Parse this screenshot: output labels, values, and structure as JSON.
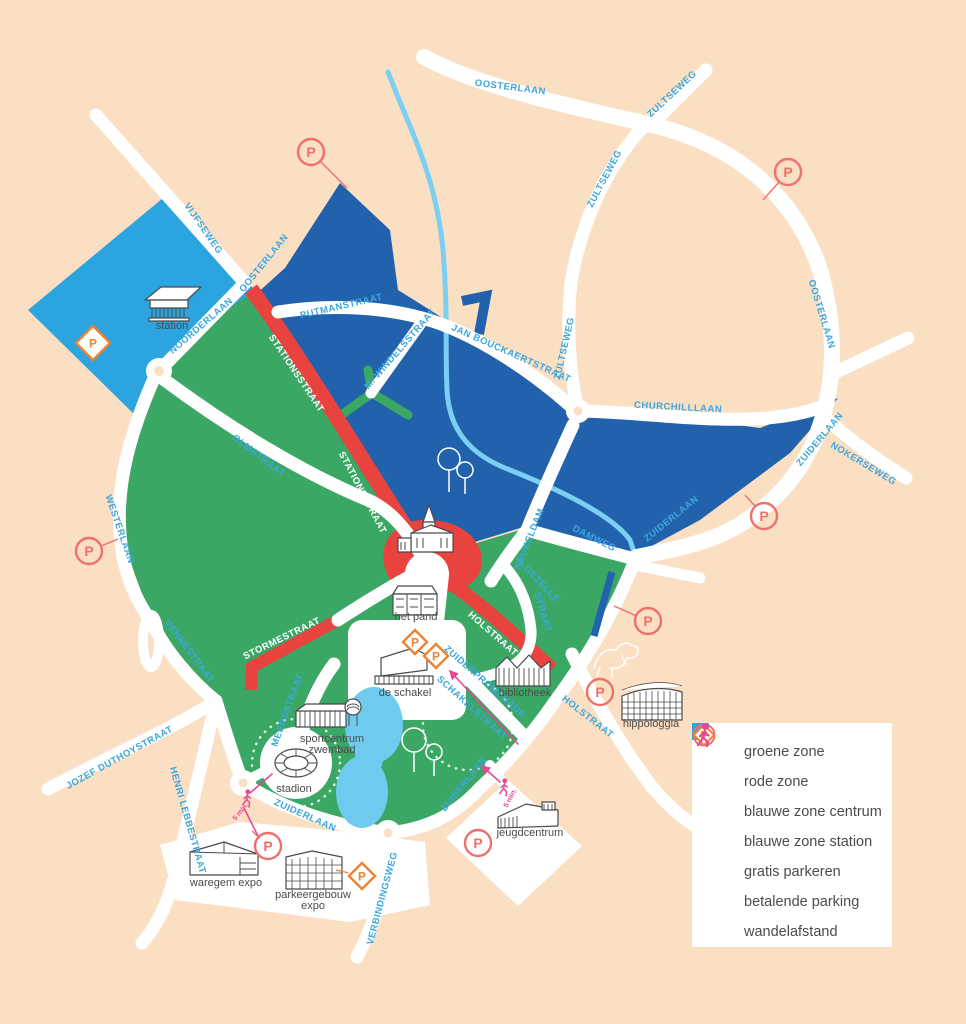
{
  "colors": {
    "background": "#FBDFC3",
    "road": "#FFFFFF",
    "green_zone": "#3BA765",
    "red_zone": "#E8433F",
    "blue_zone_centrum": "#2262AC",
    "blue_zone_station": "#2BA4DF",
    "canal": "#7ACFF2",
    "street_label": "#3BA7DF",
    "walk_pink": "#E84793",
    "p_circle": "#F06F6B",
    "p_diamond": "#EE8330",
    "label_text": "#4B4B4B"
  },
  "legend": {
    "items": [
      {
        "label": "groene zone",
        "type": "swatch",
        "color": "#3BA765"
      },
      {
        "label": "rode zone",
        "type": "swatch",
        "color": "#E8433F"
      },
      {
        "label": "blauwe zone centrum",
        "type": "swatch",
        "color": "#2262AC"
      },
      {
        "label": "blauwe zone station",
        "type": "swatch",
        "color": "#2BA4DF"
      },
      {
        "label": "gratis parkeren",
        "type": "p-circle"
      },
      {
        "label": "betalende parking",
        "type": "p-diamond"
      },
      {
        "label": "wandelafstand",
        "type": "walker"
      }
    ]
  },
  "map": {
    "street_labels": [
      {
        "name": "OOSTERLAAN",
        "x": 510,
        "y": 90,
        "rot": 7
      },
      {
        "name": "ZULTSEWEG",
        "x": 674,
        "y": 96,
        "rot": -43
      },
      {
        "name": "ZULTSEWEG",
        "x": 607,
        "y": 180,
        "rot": -62
      },
      {
        "name": "ZULTSEWEG",
        "x": 567,
        "y": 349,
        "rot": -77
      },
      {
        "name": "OOSTERLAAN",
        "x": 819,
        "y": 315,
        "rot": 73
      },
      {
        "name": "ZUIDERLAAN",
        "x": 822,
        "y": 441,
        "rot": -50
      },
      {
        "name": "NOKERSEWEG",
        "x": 862,
        "y": 466,
        "rot": 31
      },
      {
        "name": "CHURCHILLLAAN",
        "x": 678,
        "y": 410,
        "rot": 3
      },
      {
        "name": "VIJFSEWEG",
        "x": 201,
        "y": 230,
        "rot": 55
      },
      {
        "name": "OOSTERLAAN",
        "x": 266,
        "y": 265,
        "rot": -51
      },
      {
        "name": "NOORDERLAAN",
        "x": 203,
        "y": 328,
        "rot": -41
      },
      {
        "name": "PUTMANSTRAAT",
        "x": 342,
        "y": 309,
        "rot": -13
      },
      {
        "name": "JAN BOUCKAERTSTRAAT",
        "x": 510,
        "y": 356,
        "rot": 24
      },
      {
        "name": "M. WINDELSSTRAAT",
        "x": 402,
        "y": 351,
        "rot": -49
      },
      {
        "name": "STATIONSSTRAAT",
        "x": 294,
        "y": 375,
        "rot": 56,
        "on_red": true
      },
      {
        "name": "STATIONSSTRAAT",
        "x": 360,
        "y": 494,
        "rot": 62,
        "on_red": true
      },
      {
        "name": "WESTERLAAN",
        "x": 117,
        "y": 530,
        "rot": 71
      },
      {
        "name": "OLMSTRAAT",
        "x": 257,
        "y": 458,
        "rot": 37
      },
      {
        "name": "KEUKELDAM",
        "x": 532,
        "y": 540,
        "rot": -68
      },
      {
        "name": "DAMWEG",
        "x": 593,
        "y": 541,
        "rot": 27
      },
      {
        "name": "ZUIDERLAAN",
        "x": 673,
        "y": 521,
        "rot": -39
      },
      {
        "name": "G.GEZELLE",
        "x": 536,
        "y": 582,
        "rot": 46
      },
      {
        "name": "STRAAT",
        "x": 540,
        "y": 613,
        "rot": 73
      },
      {
        "name": "HOLSTRAAT",
        "x": 491,
        "y": 636,
        "rot": 41,
        "on_red": true
      },
      {
        "name": "HOLSTRAAT",
        "x": 586,
        "y": 719,
        "rot": 38
      },
      {
        "name": "STORMESTRAAT",
        "x": 283,
        "y": 641,
        "rot": -26,
        "on_red": true
      },
      {
        "name": "VENNESTRAAT",
        "x": 187,
        "y": 653,
        "rot": 53
      },
      {
        "name": "MEERSSTRAAT",
        "x": 290,
        "y": 711,
        "rot": -70
      },
      {
        "name": "JOZEF DUTHOYSTRAAT",
        "x": 121,
        "y": 760,
        "rot": -29
      },
      {
        "name": "HENRI LEBBESTRAAT",
        "x": 185,
        "y": 821,
        "rot": 74
      },
      {
        "name": "ZUIDERLAAN",
        "x": 304,
        "y": 818,
        "rot": 24
      },
      {
        "name": "ZUIDERLAAN",
        "x": 466,
        "y": 786,
        "rot": -51
      },
      {
        "name": "ZUIDERPROMENADE",
        "x": 483,
        "y": 684,
        "rot": 41
      },
      {
        "name": "SCHAKELSTRAAT",
        "x": 470,
        "y": 710,
        "rot": 42
      },
      {
        "name": "VERBINDINGSWEG",
        "x": 385,
        "y": 899,
        "rot": -75
      }
    ],
    "landmark_labels": [
      {
        "lines": [
          "station"
        ],
        "x": 172,
        "y": 329
      },
      {
        "lines": [
          "markt"
        ],
        "x": 430,
        "y": 580,
        "on_red": true
      },
      {
        "lines": [
          "het pand"
        ],
        "x": 416,
        "y": 620
      },
      {
        "lines": [
          "de schakel"
        ],
        "x": 405,
        "y": 696
      },
      {
        "lines": [
          "bibliotheek"
        ],
        "x": 525,
        "y": 696
      },
      {
        "lines": [
          "sportcentrum",
          "zwembad"
        ],
        "x": 332,
        "y": 742
      },
      {
        "lines": [
          "stadion"
        ],
        "x": 294,
        "y": 792
      },
      {
        "lines": [
          "waregem expo"
        ],
        "x": 226,
        "y": 886
      },
      {
        "lines": [
          "parkeergebouw",
          "expo"
        ],
        "x": 313,
        "y": 898
      },
      {
        "lines": [
          "jeugdcentrum"
        ],
        "x": 530,
        "y": 836
      },
      {
        "lines": [
          "hippologgia"
        ],
        "x": 651,
        "y": 727
      }
    ],
    "parkings": [
      {
        "type": "circle",
        "x": 311,
        "y": 152,
        "lx": 347,
        "ly": 188
      },
      {
        "type": "circle",
        "x": 788,
        "y": 172,
        "lx": 763,
        "ly": 200
      },
      {
        "type": "circle",
        "x": 89,
        "y": 551,
        "lx": 118,
        "ly": 539
      },
      {
        "type": "circle",
        "x": 764,
        "y": 516,
        "lx": 745,
        "ly": 495
      },
      {
        "type": "circle",
        "x": 648,
        "y": 621,
        "lx": 614,
        "ly": 606
      },
      {
        "type": "circle",
        "x": 600,
        "y": 692
      },
      {
        "type": "circle",
        "x": 268,
        "y": 846,
        "lx": 252,
        "ly": 831
      },
      {
        "type": "circle",
        "x": 478,
        "y": 843
      },
      {
        "type": "diamond",
        "x": 93,
        "y": 343,
        "size": 17
      },
      {
        "type": "diamond",
        "x": 415,
        "y": 642,
        "size": 12
      },
      {
        "type": "diamond",
        "x": 436,
        "y": 656,
        "size": 12
      },
      {
        "type": "diamond",
        "x": 362,
        "y": 876,
        "size": 13,
        "lx": 336,
        "ly": 870
      }
    ],
    "walkers": [
      {
        "x": 247,
        "y": 799,
        "label": "5 min.",
        "lx": -5,
        "ly": 14,
        "lrot": -50
      },
      {
        "x": 504,
        "y": 788,
        "label": "5 min.",
        "lx": 8,
        "ly": 11,
        "lrot": -62
      }
    ]
  }
}
